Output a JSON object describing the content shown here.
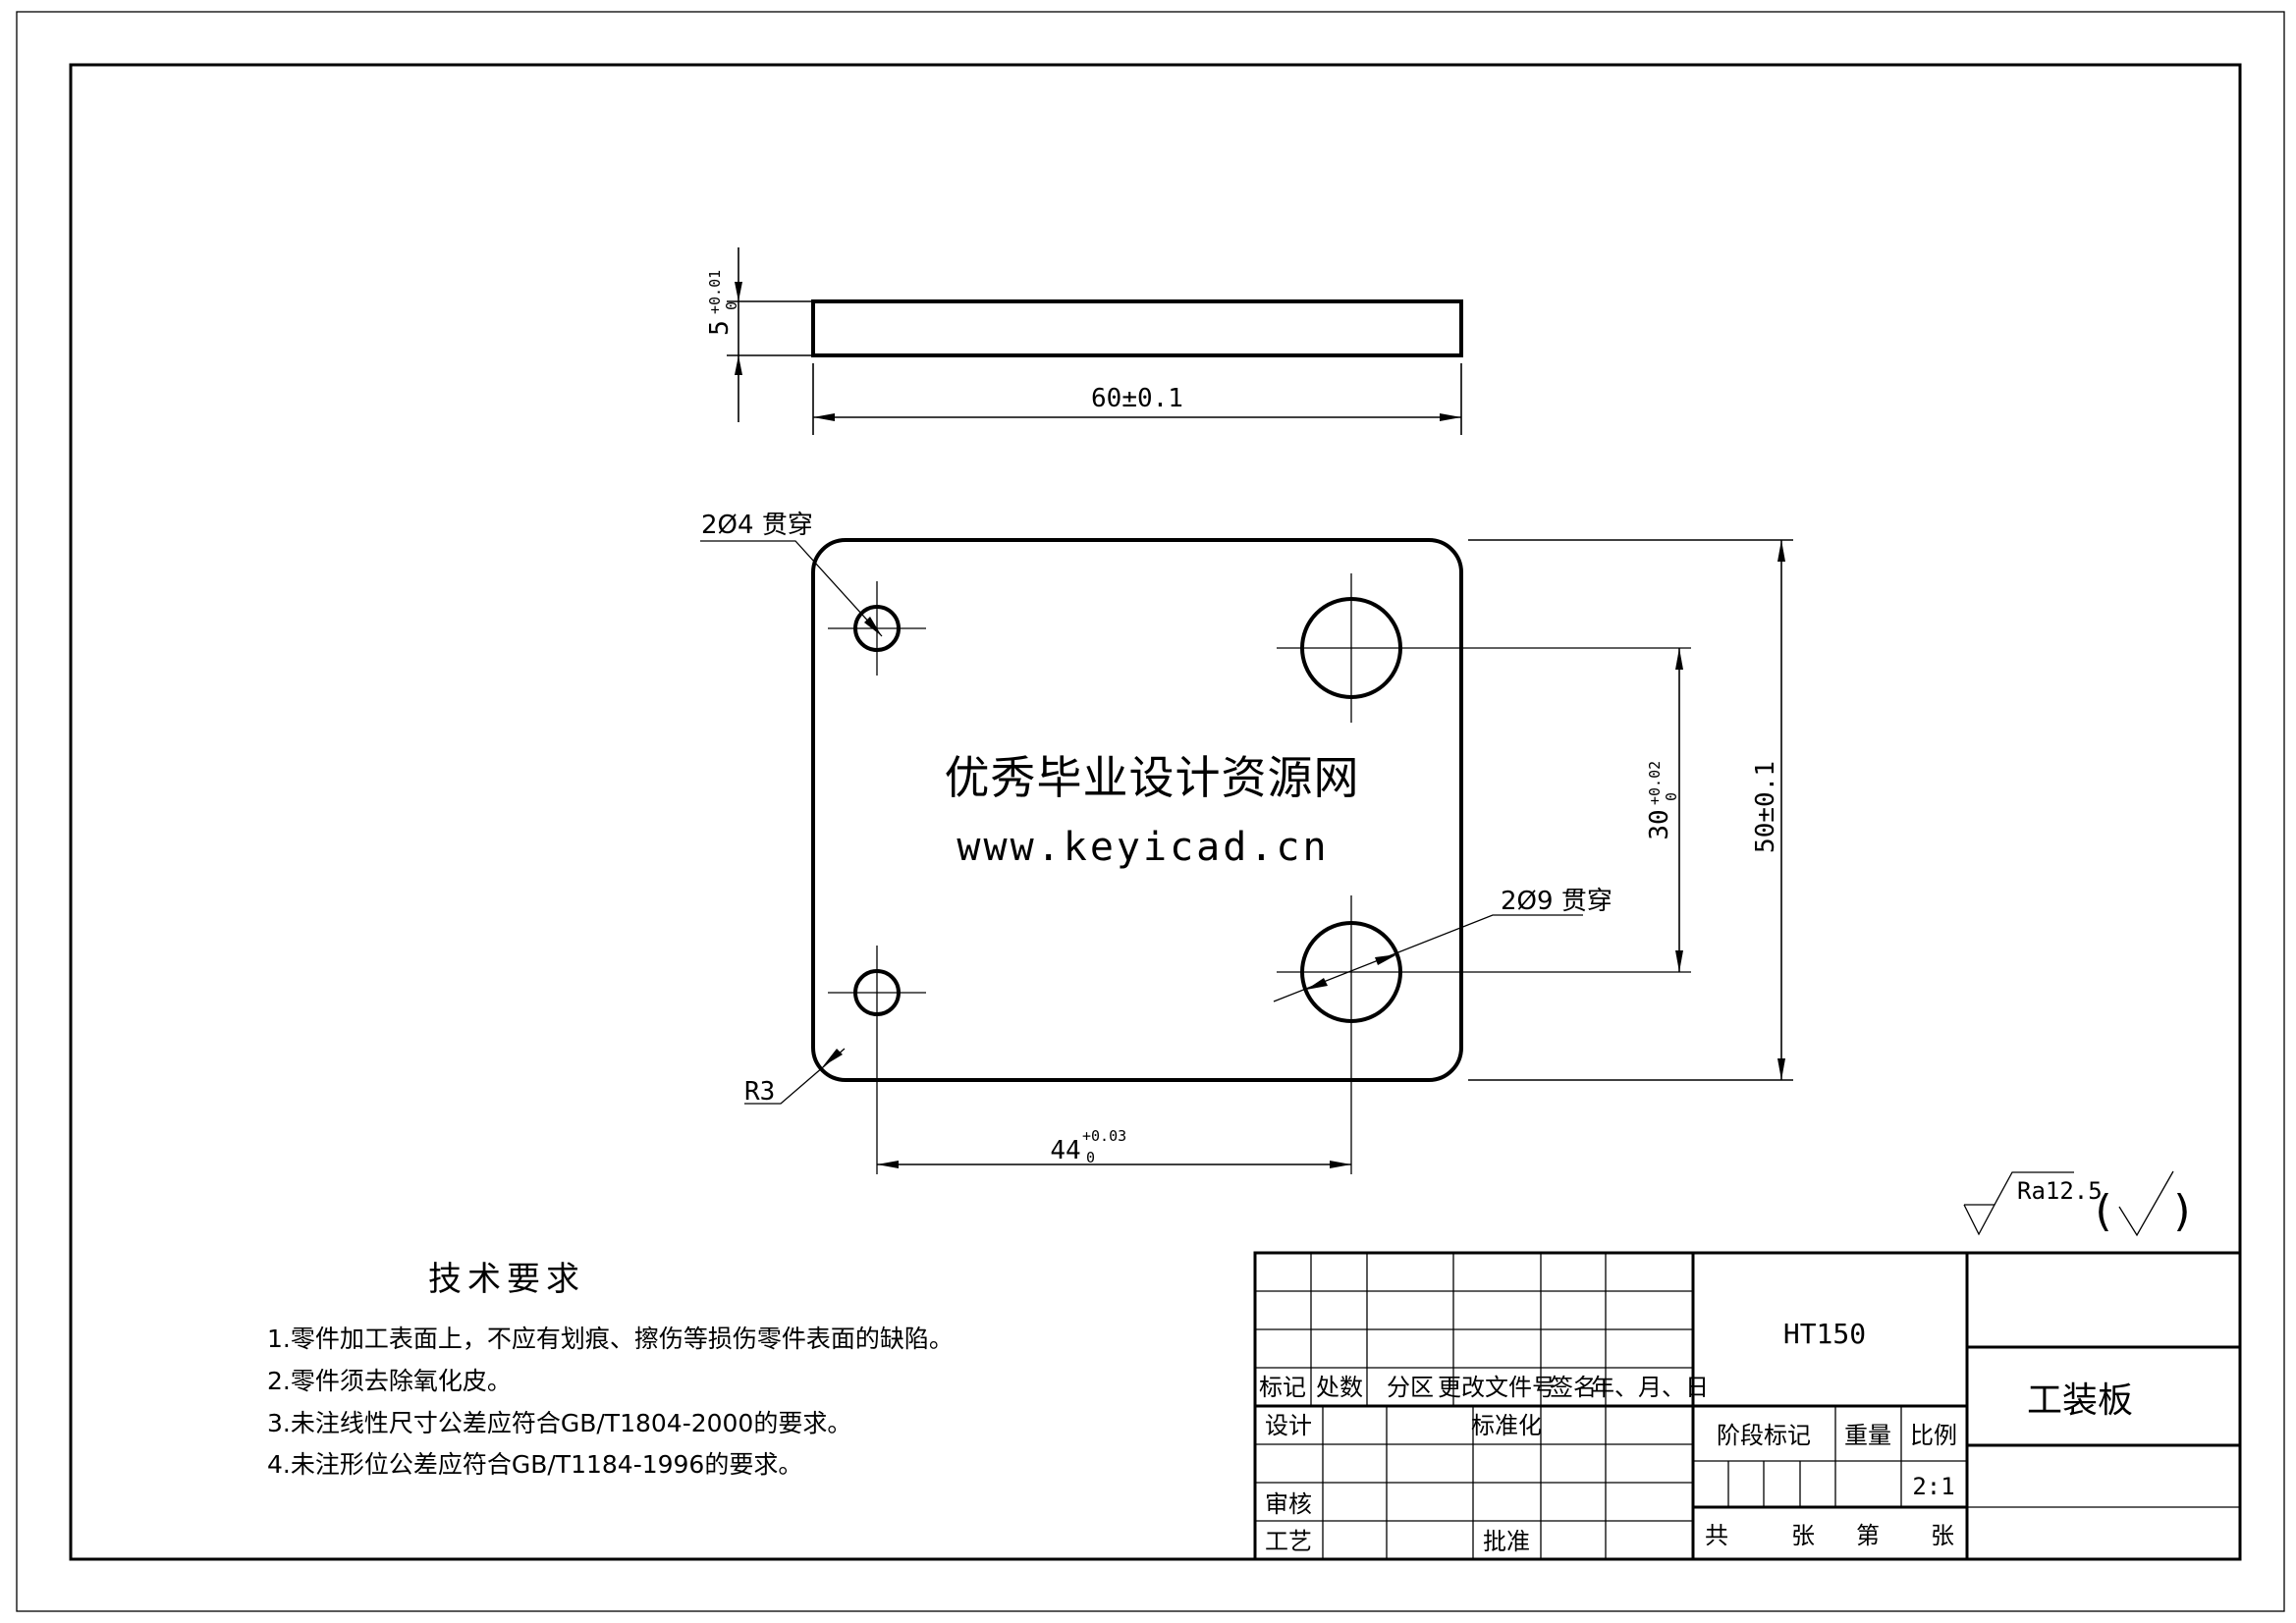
{
  "page": {
    "background": "#ffffff",
    "line_color": "#000000",
    "watermark_color": "#e00000"
  },
  "side_view": {
    "dim_thickness": {
      "value": "5",
      "tol_upper": "+0.01",
      "tol_lower": "0"
    },
    "dim_length": "60±0.1"
  },
  "front_view": {
    "label_small_holes": "2Ø4 贯穿",
    "label_big_holes": "2Ø9 贯穿",
    "label_corner_radius": "R3",
    "dim_height": "50±0.1",
    "dim_hole_spacing_vertical": {
      "value": "30",
      "tol_upper": "+0.02",
      "tol_lower": "0"
    },
    "dim_hole_spacing_horizontal": {
      "value": "44",
      "tol_upper": "+0.03",
      "tol_lower": "0"
    }
  },
  "watermark": {
    "line1": "优秀毕业设计资源网",
    "line2": "www.keyicad.cn",
    "color": "#e00000"
  },
  "tech_requirements": {
    "title": "技术要求",
    "items": [
      "1.零件加工表面上，不应有划痕、擦伤等损伤零件表面的缺陷。",
      "2.零件须去除氧化皮。",
      "3.未注线性尺寸公差应符合GB/T1804-2000的要求。",
      "4.未注形位公差应符合GB/T1184-1996的要求。"
    ]
  },
  "roughness": {
    "value": "Ra12.5",
    "paren_open": "(",
    "paren_close": ")"
  },
  "title_block": {
    "material": "HT150",
    "part_name": "工装板",
    "scale_value": "2:1",
    "rev_headers": [
      "标记",
      "处数",
      "分区",
      "更改文件号",
      "签名",
      "年、月、日"
    ],
    "sign_labels": {
      "design": "设计",
      "standardize": "标准化",
      "check": "审核",
      "process": "工艺",
      "approve": "批准"
    },
    "info_headers": {
      "stage": "阶段标记",
      "weight": "重量",
      "scale": "比例"
    },
    "sheet_row": [
      "共",
      "张",
      "第",
      "张"
    ]
  }
}
